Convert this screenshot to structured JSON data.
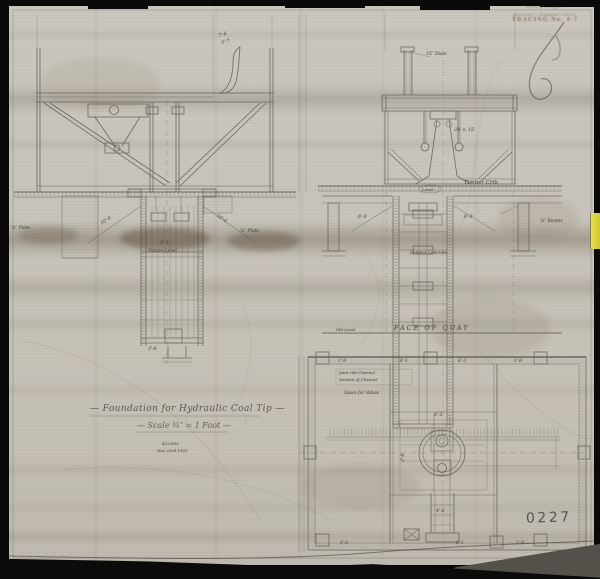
{
  "sheet": {
    "title": "— Foundation for Hydraulic Coal Tip —",
    "scale_note": "— Scale ¾″ = 1 Foot —",
    "drawing_number": "0227",
    "ref_number": "4223/93",
    "date_note": "Nov 23rd 1931"
  },
  "stamp": {
    "line1": "Dock Dept.",
    "line2": "Received — Engineer's Office",
    "line3": "TRACING No. 4-7"
  },
  "labels": {
    "horn_dim_upper": "7'-6",
    "horn_dim_lower": "5'-7",
    "post_diameter": "15″ Diam",
    "beam_size": "24 × 15",
    "timber_crib": "Timber Crib",
    "level": "Level",
    "left_foundation_dim_left": "10'-6",
    "left_foundation_dim_right": "10'-6",
    "plate_left": "⅝″ Plate",
    "plate_right": "⅝″ Plate",
    "beams_right": "⅝″ Beams",
    "shaft_dim": "8'-6",
    "datum_level": "Datum Level",
    "shaft_foot_dim": "3'-6",
    "section_dim_left": "6'-0",
    "section_dim_right": "6'-0",
    "concrete": "Cement Concrete",
    "face_of_quay": "FACE OF QUAY",
    "old_level": "Old Level",
    "plan_top_dim_1": "1'-9",
    "plan_top_dim_2": "6'-1",
    "plan_top_dim_3": "6'-3",
    "plan_top_dim_4": "1'-9",
    "plan_center_dim": "5'-2",
    "plan_left_dim": "3'-6",
    "plan_stem_dim": "4'-6",
    "plan_bottom_dim_1": "1'-0",
    "plan_bottom_dim_2": "6'-1",
    "plan_bottom_dim_3": "1'-0",
    "plan_note_1": "Joint Old Channel",
    "plan_note_2": "Section of Channel",
    "plan_note_3": "Space for Valves"
  },
  "colors": {
    "paper": "#c8c4bb",
    "pencil": "#565248",
    "sticky_tab": "#e8e23a",
    "stamp_ink": "#6d5244"
  }
}
